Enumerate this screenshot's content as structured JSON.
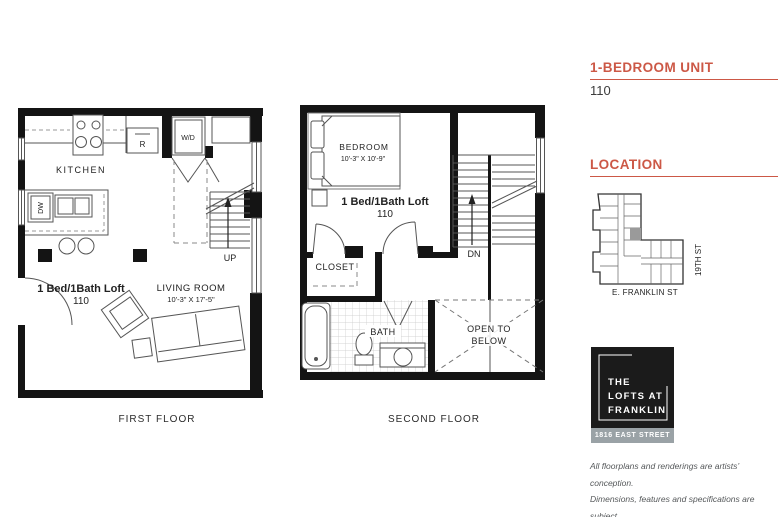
{
  "accent_color": "#CC5846",
  "sidebar": {
    "unit_title": "1-BEDROOM UNIT",
    "unit_number": "110",
    "location_title": "LOCATION",
    "map": {
      "street_vertical": "19TH ST",
      "street_horizontal": "E. FRANKLIN ST"
    },
    "logo": {
      "line1": "THE",
      "line2": "LOFTS AT",
      "line3": "FRANKLIN",
      "address": "1816 EAST STREET"
    },
    "disclaimer_lines": [
      "All floorplans and renderings are artists’ conception.",
      "Dimensions, features and specifications are subject",
      "to change at the discretion of the builder."
    ]
  },
  "first_floor": {
    "caption": "FIRST FLOOR",
    "labels": {
      "kitchen": "KITCHEN",
      "unit_type": "1 Bed/1Bath Loft",
      "unit_number": "110",
      "living_room": "LIVING ROOM",
      "living_room_dims": "10'-3\" X 17'-5\"",
      "up": "UP",
      "washer_dryer": "W/D",
      "refrigerator": "R",
      "dishwasher": "DW"
    }
  },
  "second_floor": {
    "caption": "SECOND FLOOR",
    "labels": {
      "bedroom": "BEDROOM",
      "bedroom_dims": "10'-3\" X 10'-9\"",
      "unit_type": "1 Bed/1Bath Loft",
      "unit_number": "110",
      "closet": "CLOSET",
      "bath": "BATH",
      "open_to_below_line1": "OPEN TO",
      "open_to_below_line2": "BELOW",
      "down": "DN"
    }
  }
}
